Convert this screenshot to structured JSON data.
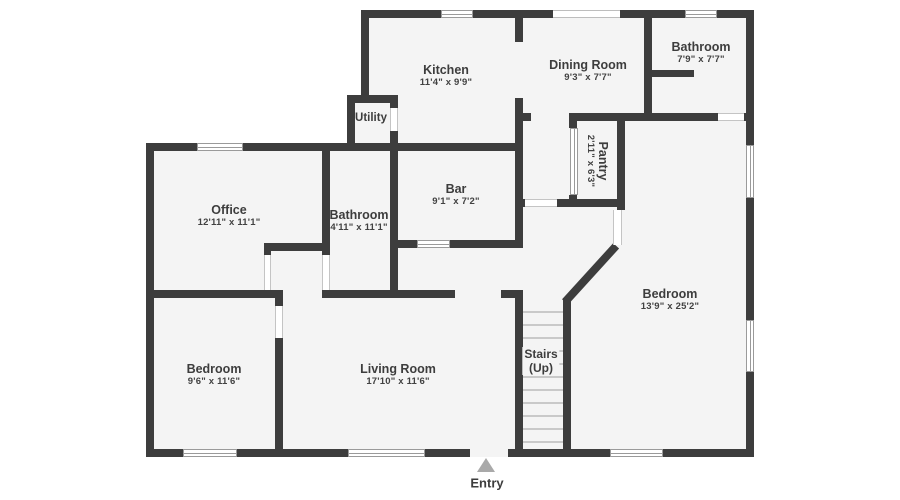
{
  "palette": {
    "wall": "#3d3d3d",
    "room_fill": "#f4f4f4",
    "background": "#ffffff",
    "window_frame": "#9a9a9a",
    "stair_tread": "#c9c9c9",
    "text": "#3d3d3d",
    "entry_arrow": "#a9a9a9"
  },
  "rooms": [
    {
      "name": "Kitchen",
      "dims": "11'4\" x 9'9\""
    },
    {
      "name": "Dining Room",
      "dims": "9'3\" x 7'7\""
    },
    {
      "name": "Bathroom",
      "dims": "7'9\" x 7'7\""
    },
    {
      "name": "Utility",
      "dims": ""
    },
    {
      "name": "Pantry",
      "dims": "2'11\" x 6'3\""
    },
    {
      "name": "Office",
      "dims": "12'11\" x 11'1\""
    },
    {
      "name": "Bathroom",
      "dims": "4'11\" x 11'1\""
    },
    {
      "name": "Bar",
      "dims": "9'1\" x 7'2\""
    },
    {
      "name": "Bedroom",
      "dims": "13'9\" x 25'2\""
    },
    {
      "name": "Bedroom",
      "dims": "9'6\" x 11'6\""
    },
    {
      "name": "Living Room",
      "dims": "17'10\" x 11'6\""
    }
  ],
  "stairs": {
    "line1": "Stairs",
    "line2": "(Up)"
  },
  "entry": {
    "label": "Entry"
  }
}
